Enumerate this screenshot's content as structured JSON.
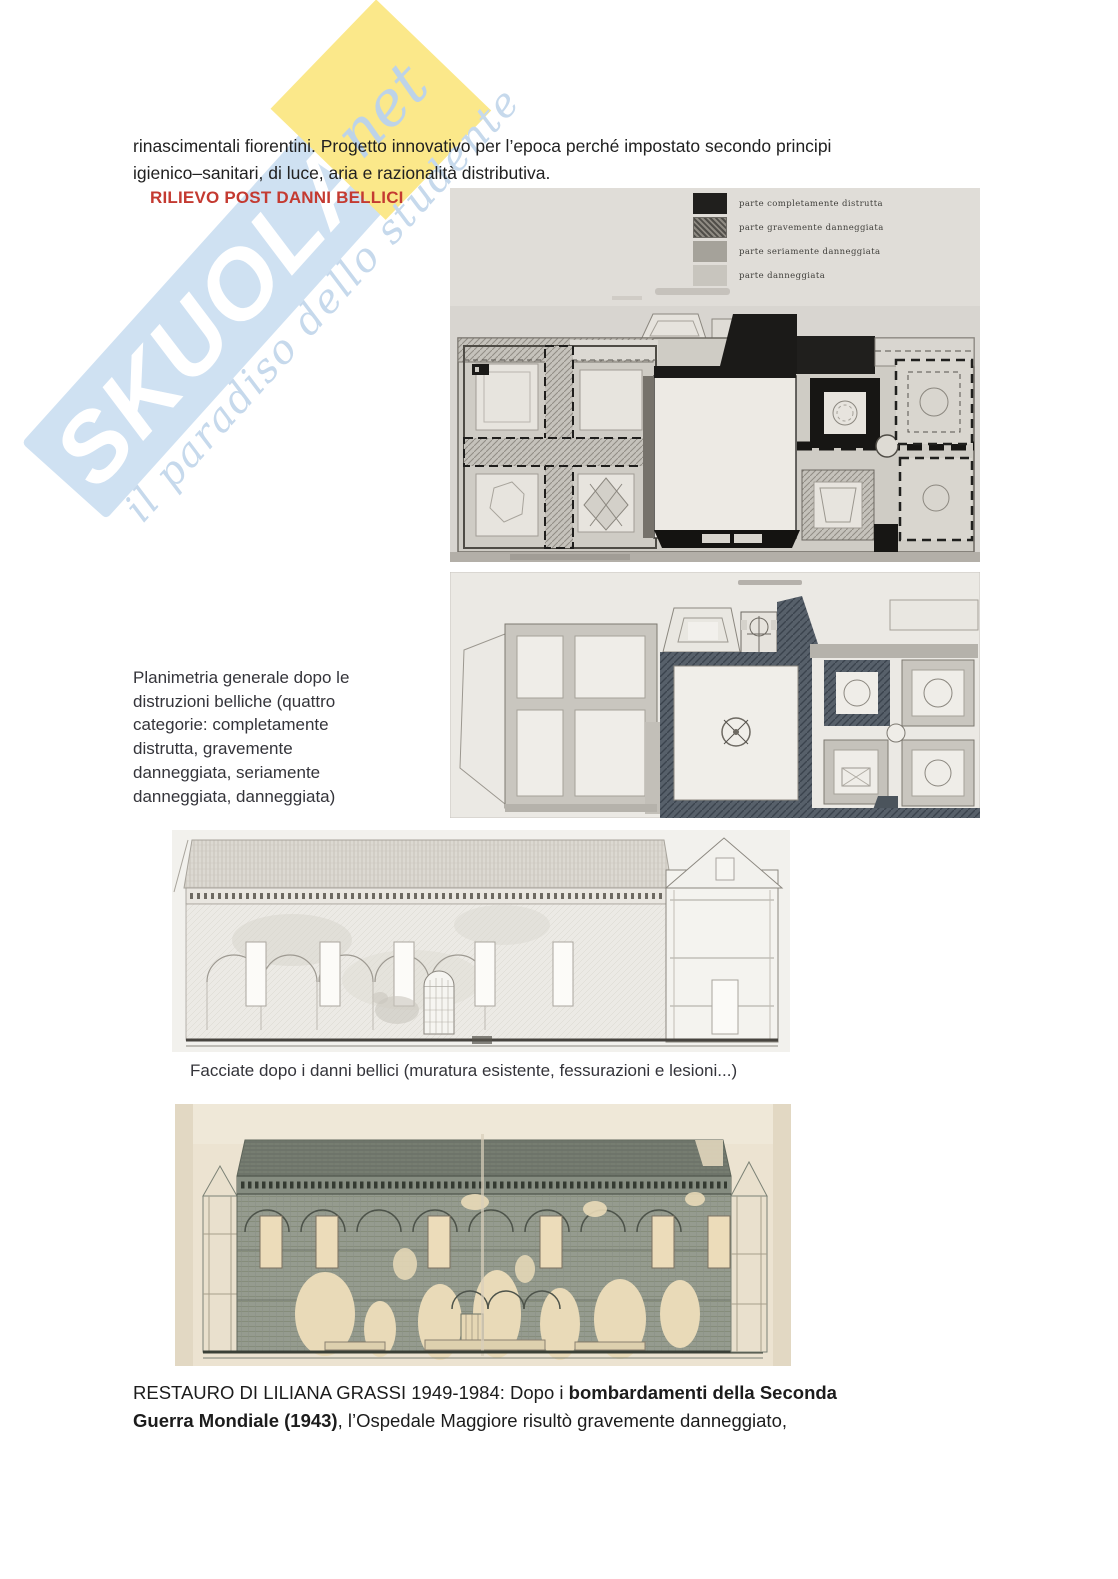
{
  "page": {
    "width": 1118,
    "height": 1579,
    "background": "#ffffff"
  },
  "colors": {
    "heading_red": "#c43a31",
    "body_text": "#212121",
    "caption_text": "#34343a",
    "watermark_band_blue": "#cfe1f2",
    "watermark_script_blue": "#c6d9ec",
    "watermark_yellow": "#fbe88a",
    "legend_black": "#201f1d",
    "legend_dark_gray": "#8e8a82",
    "legend_mid_gray": "#a5a29a",
    "legend_light_gray": "#c8c5be"
  },
  "watermark": {
    "brand": "SKUOLA",
    "net": "net",
    "tagline": "il paradiso dello studente"
  },
  "intro": {
    "lines": [
      "rinascimentali fiorentini. Progetto innovativo per l’epoca perché impostato secondo principi",
      "igienico–sanitari, di luce, aria e razionalità distributiva."
    ]
  },
  "heading": {
    "text": "RILIEVO POST DANNI BELLICI"
  },
  "plan1": {
    "legend": [
      {
        "label": "parte completamente distrutta",
        "swatch": "black"
      },
      {
        "label": "parte gravemente danneggiata",
        "swatch": "dark-hatch"
      },
      {
        "label": "parte seriamente danneggiata",
        "swatch": "mid-gray"
      },
      {
        "label": "parte danneggiata",
        "swatch": "light-gray"
      }
    ]
  },
  "captions": {
    "planimetria_lines": [
      "Planimetria generale dopo le",
      "distruzioni belliche (quattro",
      "categorie: completamente",
      "distrutta, gravemente",
      "danneggiata, seriamente",
      "danneggiata, danneggiata)"
    ],
    "facciate": "Facciate dopo i danni bellici (muratura esistente, fessurazioni e lesioni...)"
  },
  "restauro": {
    "line1": [
      {
        "text": "RESTAURO DI LILIANA GRASSI 1949-1984: Dopo i ",
        "bold": false
      },
      {
        "text": "bombardamenti della Seconda",
        "bold": true
      }
    ],
    "line2": [
      {
        "text": "Guerra Mondiale (1943)",
        "bold": true
      },
      {
        "text": ", l’Ospedale Maggiore risultò gravemente danneggiato,",
        "bold": false
      }
    ]
  }
}
